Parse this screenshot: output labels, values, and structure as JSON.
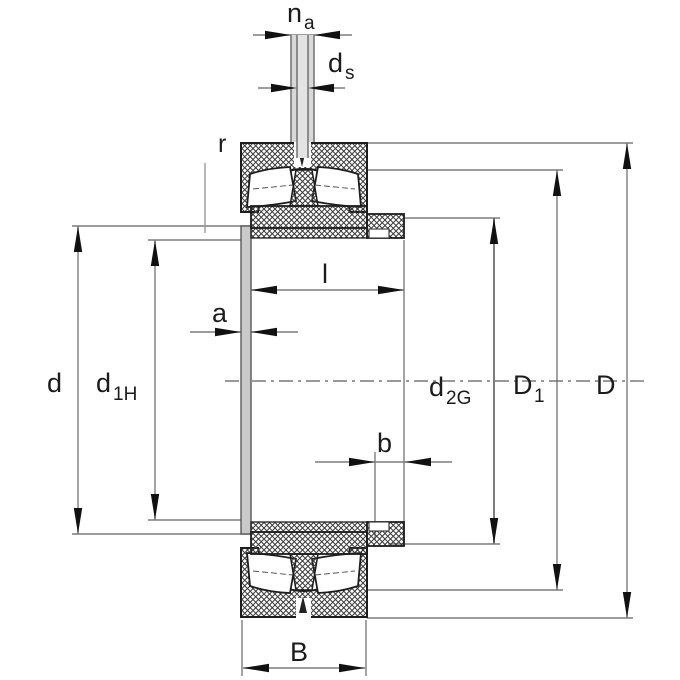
{
  "drawing": {
    "title": "bearing-with-adapter-sleeve-dimension-drawing",
    "colors": {
      "background": "#ffffff",
      "part_outline": "#1d1d1d",
      "hatch": "#3a3a3a",
      "dimension_line": "#7d7d7d",
      "arrow": "#111111",
      "sleeve_fill": "#c9c9c9",
      "pin_fill": "#d8d8d8"
    },
    "labels": {
      "na": {
        "base": "n",
        "sub": "a"
      },
      "ds": {
        "base": "d",
        "sub": "s"
      },
      "r": {
        "base": "r"
      },
      "l": {
        "base": "l"
      },
      "a": {
        "base": "a"
      },
      "b": {
        "base": "b"
      },
      "B": {
        "base": "B"
      },
      "d": {
        "base": "d"
      },
      "d1H": {
        "base": "d",
        "sub": "1H"
      },
      "d2G": {
        "base": "d",
        "sub": "2G"
      },
      "D1": {
        "base": "D",
        "sub": "1"
      },
      "D": {
        "base": "D"
      }
    }
  }
}
